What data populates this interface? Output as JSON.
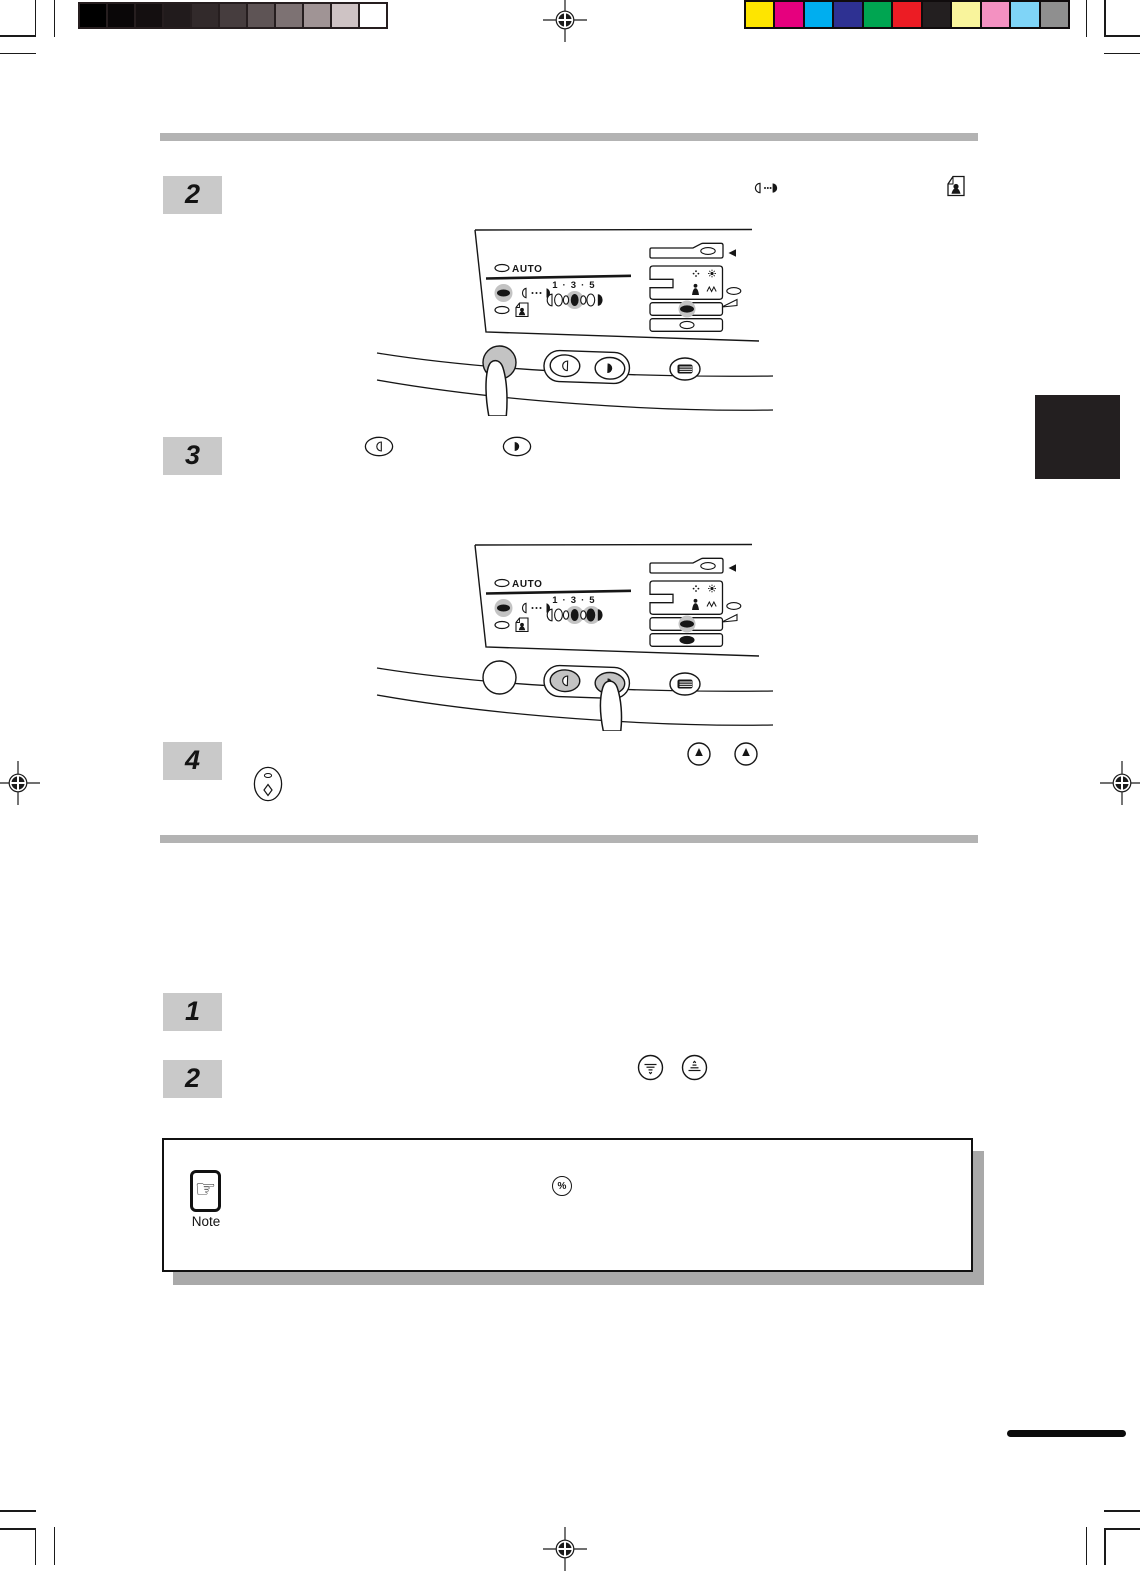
{
  "document": {
    "type": "copier operation manual page (scanned)",
    "note": {
      "label": "Note",
      "hand_glyph": "☞",
      "percent_key": "%"
    }
  },
  "steps": {
    "upper": [
      {
        "number": "2"
      },
      {
        "number": "3"
      },
      {
        "number": "4"
      }
    ],
    "lower": [
      {
        "number": "1"
      },
      {
        "number": "2"
      }
    ]
  },
  "panel": {
    "auto_label": "AUTO",
    "exposure_scale_label": "1 · 3 · 5"
  },
  "icons": {
    "manual_exposure": "half-moon-dots-half-moon",
    "photo_mode": "document-with-portrait",
    "lighten_key": "outlined-half-circle",
    "darken_key": "filled-half-circle",
    "exposure_up_key": "circled-up-arrow",
    "start_key": "oval-with-diamond",
    "zoom_down_key": "circled-narrowing-lines",
    "zoom_up_key": "circled-widening-lines",
    "percent_key": "circled-percent",
    "note_hand": "pointing-hand"
  },
  "calibration": {
    "grayscale_swatches": [
      "#000000",
      "#0a0708",
      "#140f10",
      "#211b1c",
      "#322a2b",
      "#463d3e",
      "#5e5455",
      "#7d7273",
      "#a09495",
      "#cec3c4",
      "#ffffff"
    ],
    "color_swatches": [
      "#fee500",
      "#e6007e",
      "#00aeef",
      "#2e3192",
      "#00a551",
      "#ec1c24",
      "#231f20",
      "#f9f49c",
      "#f391c1",
      "#7fd4f7",
      "#8f8f8f"
    ]
  },
  "colors": {
    "step_box_bg": "#c9c9c9",
    "divider_bar": "#b3b3b3",
    "highlight_halo": "#c3c3c3",
    "note_shadow": "#a9a9a9",
    "side_tab": "#231f20",
    "ink": "#161616"
  }
}
